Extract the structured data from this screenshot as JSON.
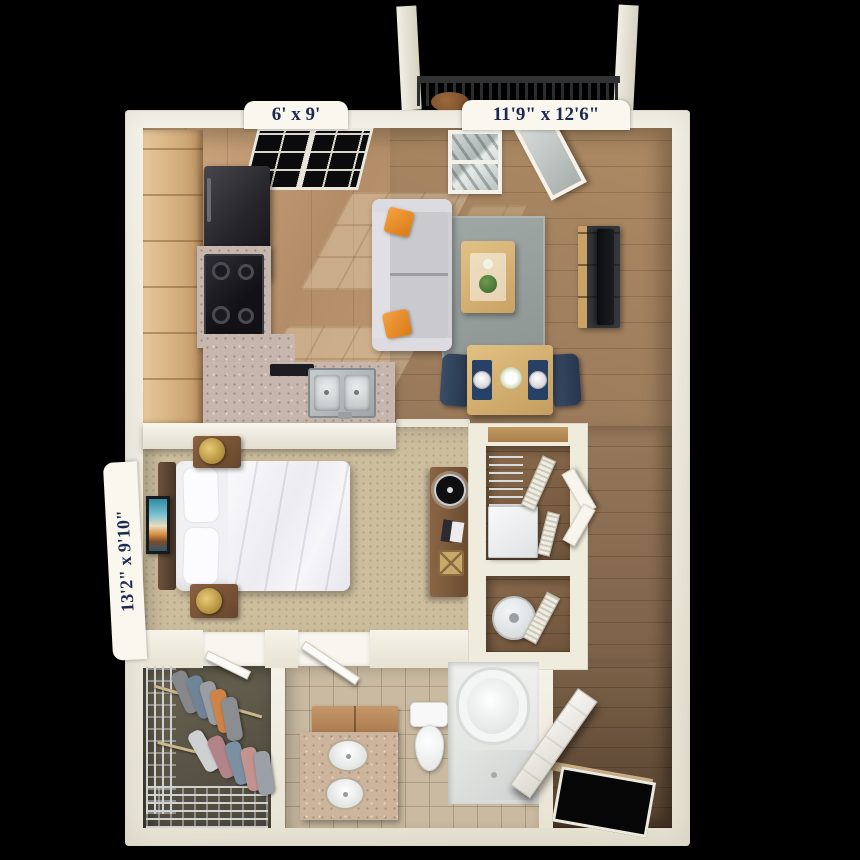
{
  "meta": {
    "type": "3d-floor-plan-render",
    "view": "top-down",
    "background": "#000000"
  },
  "labels": {
    "kitchen": "6' x 9'",
    "living": "11'9\" x 12'6\"",
    "bedroom": "13'2\" x 9'10\""
  },
  "label_style": {
    "text_color": "#1d2950",
    "tab_background": "#faf7ee"
  },
  "palette": {
    "wall": "#efebdf",
    "wood_floor_light": "#bd9772",
    "wood_floor_dark": "#7c6148",
    "carpet": "#ccbd9d",
    "bath_tile": "#c9baa1",
    "granite": "#c6b6ad",
    "cabinet_wood": "#cfa877",
    "rug": "#97a09d",
    "sofa": "#cfcfd4",
    "accent_pillow_orange": "#e8882a",
    "dining_chair_navy": "#2e3d55",
    "table_oak": "#d9b87e",
    "appliance_black": "#1a1a1f",
    "fixture_white": "#f4f6f5"
  },
  "rooms": [
    {
      "id": "balcony",
      "name": "Balcony",
      "dimensions": "",
      "features": [
        "metal-railing",
        "support-posts",
        "patio-chair"
      ]
    },
    {
      "id": "kitchen",
      "name": "Kitchen",
      "dimensions": "6' x 9'",
      "features": [
        "wood-cabinets",
        "refrigerator",
        "range-cooktop",
        "dishwasher",
        "granite-counter-peninsula",
        "double-sink",
        "window"
      ]
    },
    {
      "id": "living-dining",
      "name": "Living / Dining Room",
      "dimensions": "11'9\" x 12'6\"",
      "features": [
        "sofa",
        "orange-throw-pillows",
        "area-rug",
        "coffee-table",
        "tv-stand",
        "tv",
        "dining-table-for-two",
        "navy-chairs",
        "window",
        "balcony-door"
      ]
    },
    {
      "id": "bedroom",
      "name": "Bedroom",
      "dimensions": "13'2\" x 9'10\"",
      "features": [
        "bed",
        "headboard",
        "pillows",
        "two-nightstands",
        "brass-lamps",
        "wall-art",
        "desk",
        "record-player",
        "books",
        "basket"
      ]
    },
    {
      "id": "hall-closets",
      "name": "Hall Closets",
      "dimensions": "",
      "features": [
        "wire-shelving",
        "washer",
        "water-heater",
        "louvered-doors"
      ]
    },
    {
      "id": "walk-in-closet",
      "name": "Walk-in Closet",
      "dimensions": "",
      "features": [
        "wire-shelving",
        "hanging-clothes"
      ]
    },
    {
      "id": "bathroom",
      "name": "Bathroom",
      "dimensions": "",
      "features": [
        "double-sink-vanity",
        "toilet",
        "bathtub",
        "tile-floor"
      ]
    },
    {
      "id": "entry",
      "name": "Entry",
      "dimensions": "",
      "features": [
        "front-door",
        "wood-floor"
      ]
    }
  ]
}
